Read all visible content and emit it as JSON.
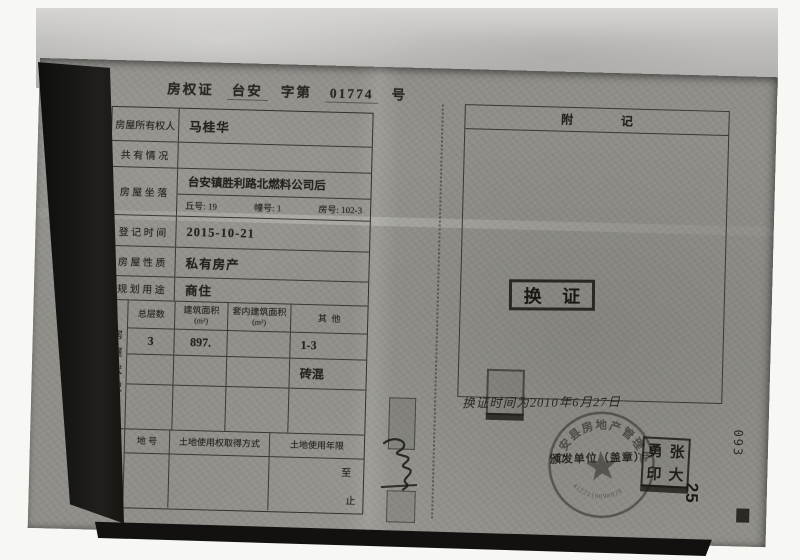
{
  "title": {
    "doc_type": "房权证",
    "region": "台安",
    "series_label": "字第",
    "number": "01774",
    "number_suffix": "号"
  },
  "table": {
    "owner": {
      "label": "房屋所有权人",
      "value": "马桂华"
    },
    "co_ownership": {
      "label": "共 有 情 况",
      "value": ""
    },
    "location": {
      "label": "房 屋 坐 落",
      "value": "台安镇胜利路北燃料公司后",
      "plot_no": "丘号: 19",
      "building_no": "幢号: 1",
      "room_no": "房号: 102-3"
    },
    "reg_date": {
      "label": "登 记 时 间",
      "value": "2015-10-21"
    },
    "nature": {
      "label": "房 屋 性 质",
      "value": "私有房产"
    },
    "usage": {
      "label": "规 划 用 途",
      "value": "商住"
    }
  },
  "house_status": {
    "section_label": "房屋状况",
    "col_headers": {
      "floors": "总层数",
      "area": "建筑面积",
      "area_unit": "(m²)",
      "inner_area": "套内建筑面积",
      "inner_area_unit": "(m²)",
      "other": "其  他"
    },
    "row1": {
      "floors": "3",
      "area": "897.",
      "inner_area": "",
      "other": "1-3"
    },
    "row2": {
      "floors": "",
      "area": "",
      "inner_area": "",
      "other": "砖混"
    },
    "row3": {
      "floors": "",
      "area": "",
      "inner_area": "",
      "other": ""
    }
  },
  "land_status": {
    "section_label": "土地状况",
    "col_headers": {
      "plot": "地 号",
      "acquisition": "土地使用权取得方式",
      "term": "土地使用年限"
    },
    "values": {
      "plot": "",
      "acquisition": ""
    },
    "term_from": "至",
    "term_to": "止"
  },
  "remarks": {
    "header": "附　　　　记",
    "exchange_stamp": "换 证",
    "handwritten_note": "换证时间为2010年6月27日"
  },
  "stamps": {
    "issuer_label": "颁发单位（盖章）",
    "round_seal_text": "台安县房地产管理处",
    "round_seal_serial": "4122210098828",
    "name_seal_chars": [
      "勇",
      "张",
      "印",
      "大"
    ]
  },
  "margins": {
    "page_number": "25",
    "side_number": "093"
  }
}
